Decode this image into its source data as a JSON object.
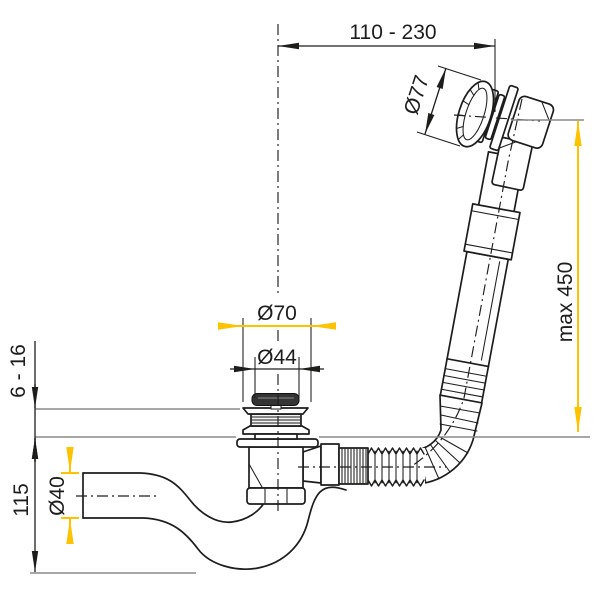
{
  "drawing": {
    "labels": {
      "span": "110 - 230",
      "cap": "Ø77",
      "hose": "max 450",
      "flange": "Ø70",
      "plug": "Ø44",
      "panel": "6 - 16",
      "depth": "115",
      "pipe": "Ø40"
    },
    "colors": {
      "line": "#1d1d1b",
      "reference": "#8a8a8a",
      "highlight": "#fdc300",
      "plug_fill": "#343434"
    }
  }
}
